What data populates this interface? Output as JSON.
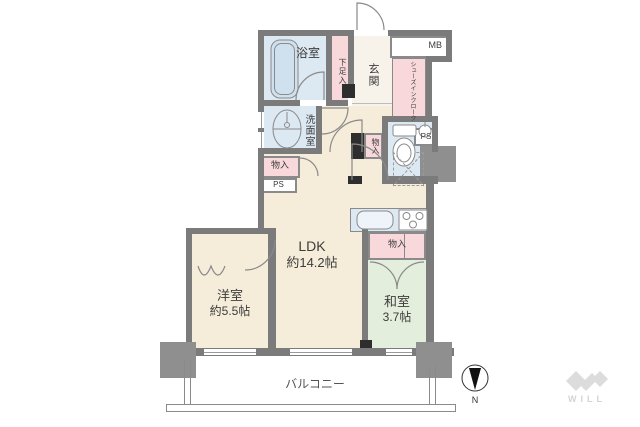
{
  "palette": {
    "wall": "#7b7b7b",
    "pillar": "#8f8f8f",
    "floor_cream": "#f6ecda",
    "wet_blue": "#dce8f2",
    "closet_pink": "#f8d8da",
    "tatami_green": "#e4eedd",
    "logo_gray": "#dcdcdc"
  },
  "rooms": {
    "bathroom": {
      "label": "浴室"
    },
    "shoe_box": {
      "label": "下足入"
    },
    "entrance": {
      "label": "玄関"
    },
    "meter_box": {
      "label": "MB"
    },
    "shoes_in_cloak": {
      "label": "シューズインクローク"
    },
    "washroom": {
      "label": "洗面室"
    },
    "storage_left": {
      "label": "物入"
    },
    "ps_left": {
      "label": "PS"
    },
    "storage_hall": {
      "label": "物入"
    },
    "ps_right": {
      "label": "PS"
    },
    "ldk": {
      "label": "LDK",
      "size": "約14.2帖"
    },
    "storage_kitchen": {
      "label": "物入"
    },
    "washitsu": {
      "label": "和室",
      "size": "3.7帖"
    },
    "yoshitsu": {
      "label": "洋室",
      "size": "約5.5帖"
    },
    "balcony": {
      "label": "バルコニー"
    }
  },
  "compass": {
    "label": "N"
  },
  "logo": {
    "label": "WILL"
  }
}
